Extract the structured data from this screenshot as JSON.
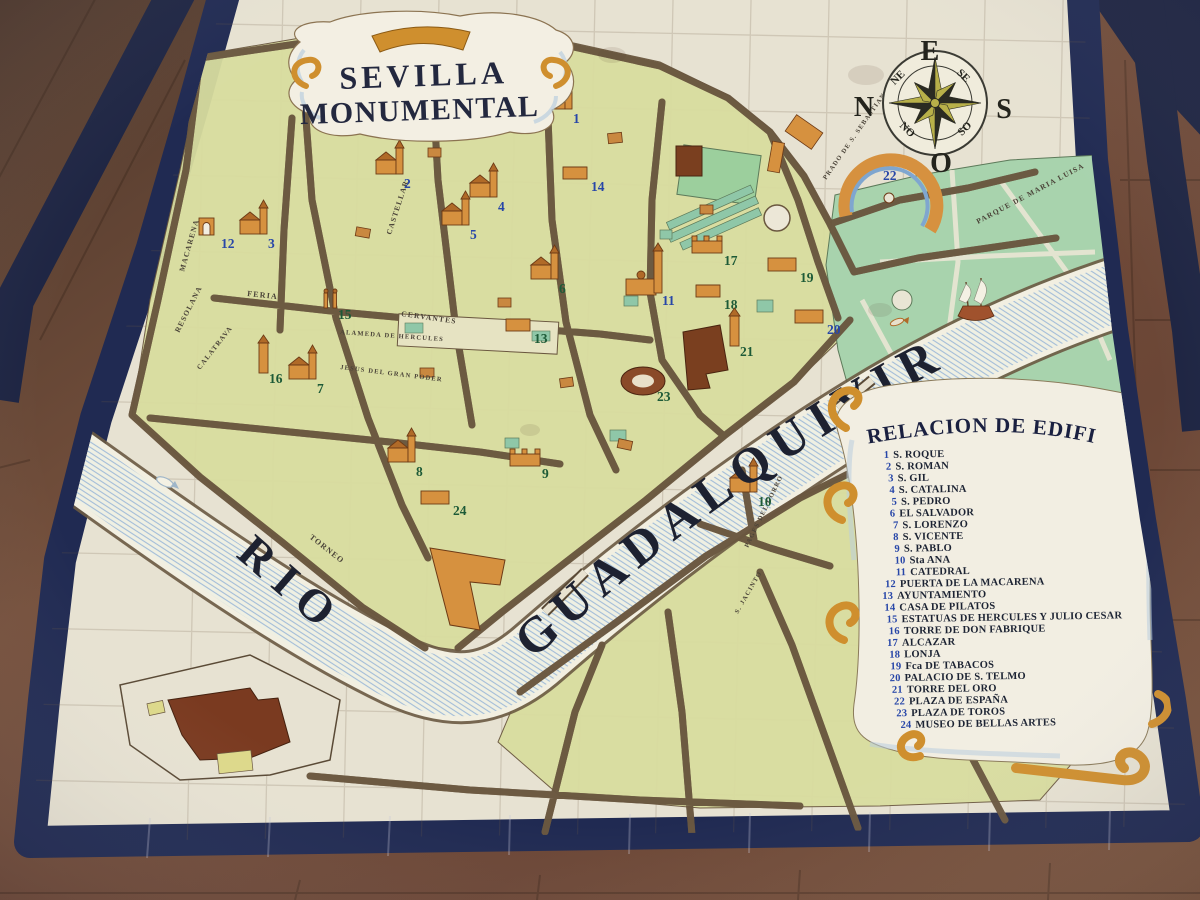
{
  "map": {
    "title_line1": "SEVILLA",
    "title_line2": "MONUMENTAL",
    "river_label_1": "RIO",
    "river_label_2": "GUADALQUIVIR"
  },
  "compass": {
    "cardinals": [
      {
        "label": "E",
        "x": 930,
        "y": 60,
        "rot": 0
      },
      {
        "label": "S",
        "x": 1004,
        "y": 118,
        "rot": 0
      },
      {
        "label": "O",
        "x": 941,
        "y": 172,
        "rot": 0
      },
      {
        "label": "N",
        "x": 864,
        "y": 116,
        "rot": 0
      }
    ],
    "intercardinals": [
      {
        "label": "NE",
        "x": 900,
        "y": 80,
        "rot": -45
      },
      {
        "label": "SE",
        "x": 961,
        "y": 78,
        "rot": 45
      },
      {
        "label": "SO",
        "x": 967,
        "y": 131,
        "rot": -45
      },
      {
        "label": "NO",
        "x": 905,
        "y": 132,
        "rot": 45
      }
    ]
  },
  "legend": {
    "title": "RELACION DE EDIFICIOS",
    "items": [
      {
        "n": "1",
        "name": "S. ROQUE"
      },
      {
        "n": "2",
        "name": "S. ROMAN"
      },
      {
        "n": "3",
        "name": "S. GIL"
      },
      {
        "n": "4",
        "name": "S. CATALINA"
      },
      {
        "n": "5",
        "name": "S. PEDRO"
      },
      {
        "n": "6",
        "name": "EL SALVADOR"
      },
      {
        "n": "7",
        "name": "S. LORENZO"
      },
      {
        "n": "8",
        "name": "S. VICENTE"
      },
      {
        "n": "9",
        "name": "S. PABLO"
      },
      {
        "n": "10",
        "name": "Sta ANA"
      },
      {
        "n": "11",
        "name": "CATEDRAL"
      },
      {
        "n": "12",
        "name": "PUERTA DE LA MACARENA"
      },
      {
        "n": "13",
        "name": "AYUNTAMIENTO"
      },
      {
        "n": "14",
        "name": "CASA DE PILATOS"
      },
      {
        "n": "15",
        "name": "ESTATUAS DE HERCULES Y JULIO CESAR"
      },
      {
        "n": "16",
        "name": "TORRE DE DON FABRIQUE"
      },
      {
        "n": "17",
        "name": "ALCAZAR"
      },
      {
        "n": "18",
        "name": "LONJA"
      },
      {
        "n": "19",
        "name": "Fca DE TABACOS"
      },
      {
        "n": "20",
        "name": "PALACIO DE S. TELMO"
      },
      {
        "n": "21",
        "name": "TORRE DEL ORO"
      },
      {
        "n": "22",
        "name": "PLAZA DE ESPAÑA"
      },
      {
        "n": "23",
        "name": "PLAZA DE TOROS"
      },
      {
        "n": "24",
        "name": "MUSEO DE BELLAS ARTES"
      }
    ]
  },
  "markers": [
    {
      "n": "1",
      "x": 571,
      "y": 119,
      "color": "blue",
      "icon": "church"
    },
    {
      "n": "2",
      "x": 402,
      "y": 184,
      "color": "blue",
      "icon": "church"
    },
    {
      "n": "3",
      "x": 266,
      "y": 244,
      "color": "blue",
      "icon": "church"
    },
    {
      "n": "4",
      "x": 496,
      "y": 207,
      "color": "blue",
      "icon": "church"
    },
    {
      "n": "5",
      "x": 468,
      "y": 235,
      "color": "blue",
      "icon": "church"
    },
    {
      "n": "6",
      "x": 557,
      "y": 289,
      "color": "green",
      "icon": "church"
    },
    {
      "n": "7",
      "x": 315,
      "y": 389,
      "color": "green",
      "icon": "church"
    },
    {
      "n": "8",
      "x": 414,
      "y": 472,
      "color": "green",
      "icon": "church"
    },
    {
      "n": "9",
      "x": 540,
      "y": 474,
      "color": "green",
      "icon": "castle"
    },
    {
      "n": "10",
      "x": 756,
      "y": 502,
      "color": "green",
      "icon": "church"
    },
    {
      "n": "11",
      "x": 660,
      "y": 301,
      "color": "blue",
      "icon": "cathedral"
    },
    {
      "n": "12",
      "x": 219,
      "y": 244,
      "color": "blue",
      "icon": "gate"
    },
    {
      "n": "13",
      "x": 532,
      "y": 339,
      "color": "green",
      "icon": "civic"
    },
    {
      "n": "14",
      "x": 589,
      "y": 187,
      "color": "blue",
      "icon": "civic"
    },
    {
      "n": "15",
      "x": 336,
      "y": 315,
      "color": "green",
      "icon": "columns"
    },
    {
      "n": "16",
      "x": 267,
      "y": 379,
      "color": "green",
      "icon": "tower"
    },
    {
      "n": "17",
      "x": 722,
      "y": 261,
      "color": "green",
      "icon": "castle"
    },
    {
      "n": "18",
      "x": 722,
      "y": 305,
      "color": "green",
      "icon": "civic"
    },
    {
      "n": "19",
      "x": 798,
      "y": 278,
      "color": "green",
      "icon": "bigrect"
    },
    {
      "n": "20",
      "x": 825,
      "y": 330,
      "color": "blue",
      "icon": "bigrect"
    },
    {
      "n": "21",
      "x": 738,
      "y": 352,
      "color": "green",
      "icon": "tower"
    },
    {
      "n": "22",
      "x": 881,
      "y": 176,
      "color": "blue",
      "icon": "none"
    },
    {
      "n": "23",
      "x": 655,
      "y": 397,
      "color": "green",
      "icon": "none"
    },
    {
      "n": "24",
      "x": 451,
      "y": 511,
      "color": "green",
      "icon": "bigrect"
    }
  ],
  "streets": [
    {
      "name": "MACARENA",
      "x": 184,
      "y": 272,
      "rot": -74,
      "size": 7.5
    },
    {
      "name": "RESOLANA",
      "x": 179,
      "y": 333,
      "rot": -63,
      "size": 7.5
    },
    {
      "name": "CALATRAVA",
      "x": 200,
      "y": 370,
      "rot": -52,
      "size": 7
    },
    {
      "name": "FERIA",
      "x": 247,
      "y": 296,
      "rot": 6,
      "size": 8
    },
    {
      "name": "CASTELLAR",
      "x": 391,
      "y": 235,
      "rot": -72,
      "size": 7.5
    },
    {
      "name": "CERVANTES",
      "x": 401,
      "y": 316,
      "rot": 8,
      "size": 7.5
    },
    {
      "name": "ALAMEDA DE HERCULES",
      "x": 340,
      "y": 334,
      "rot": 4,
      "size": 6.5
    },
    {
      "name": "JESUS DEL GRAN PODER",
      "x": 340,
      "y": 369,
      "rot": 7,
      "size": 6.5
    },
    {
      "name": "TORNEO",
      "x": 309,
      "y": 538,
      "rot": 38,
      "size": 8
    },
    {
      "name": "PAGES DEL CORRO",
      "x": 748,
      "y": 548,
      "rot": -64,
      "size": 6.5
    },
    {
      "name": "S. JACINTO",
      "x": 738,
      "y": 614,
      "rot": -60,
      "size": 6.5
    },
    {
      "name": "PRADO DE S. SEBASTIAN",
      "x": 826,
      "y": 180,
      "rot": -55,
      "size": 6.5
    },
    {
      "name": "PARQUE DE MARIA LUISA",
      "x": 978,
      "y": 224,
      "rot": -28,
      "size": 7.5
    }
  ],
  "colors": {
    "floor_terracotta": "#6e4a38",
    "navy_tile": "#1d2442",
    "map_cream": "#e7e2d2",
    "block_green": "#d9dd9f",
    "park_green": "#a8d3ad",
    "river_blue": "#7fa6cf",
    "building_orange": "#d6913f",
    "scroll_orange": "#cf8f2e",
    "marker_blue": "#2746a8",
    "marker_green": "#1d5a37",
    "text_navy": "#1b2138"
  }
}
